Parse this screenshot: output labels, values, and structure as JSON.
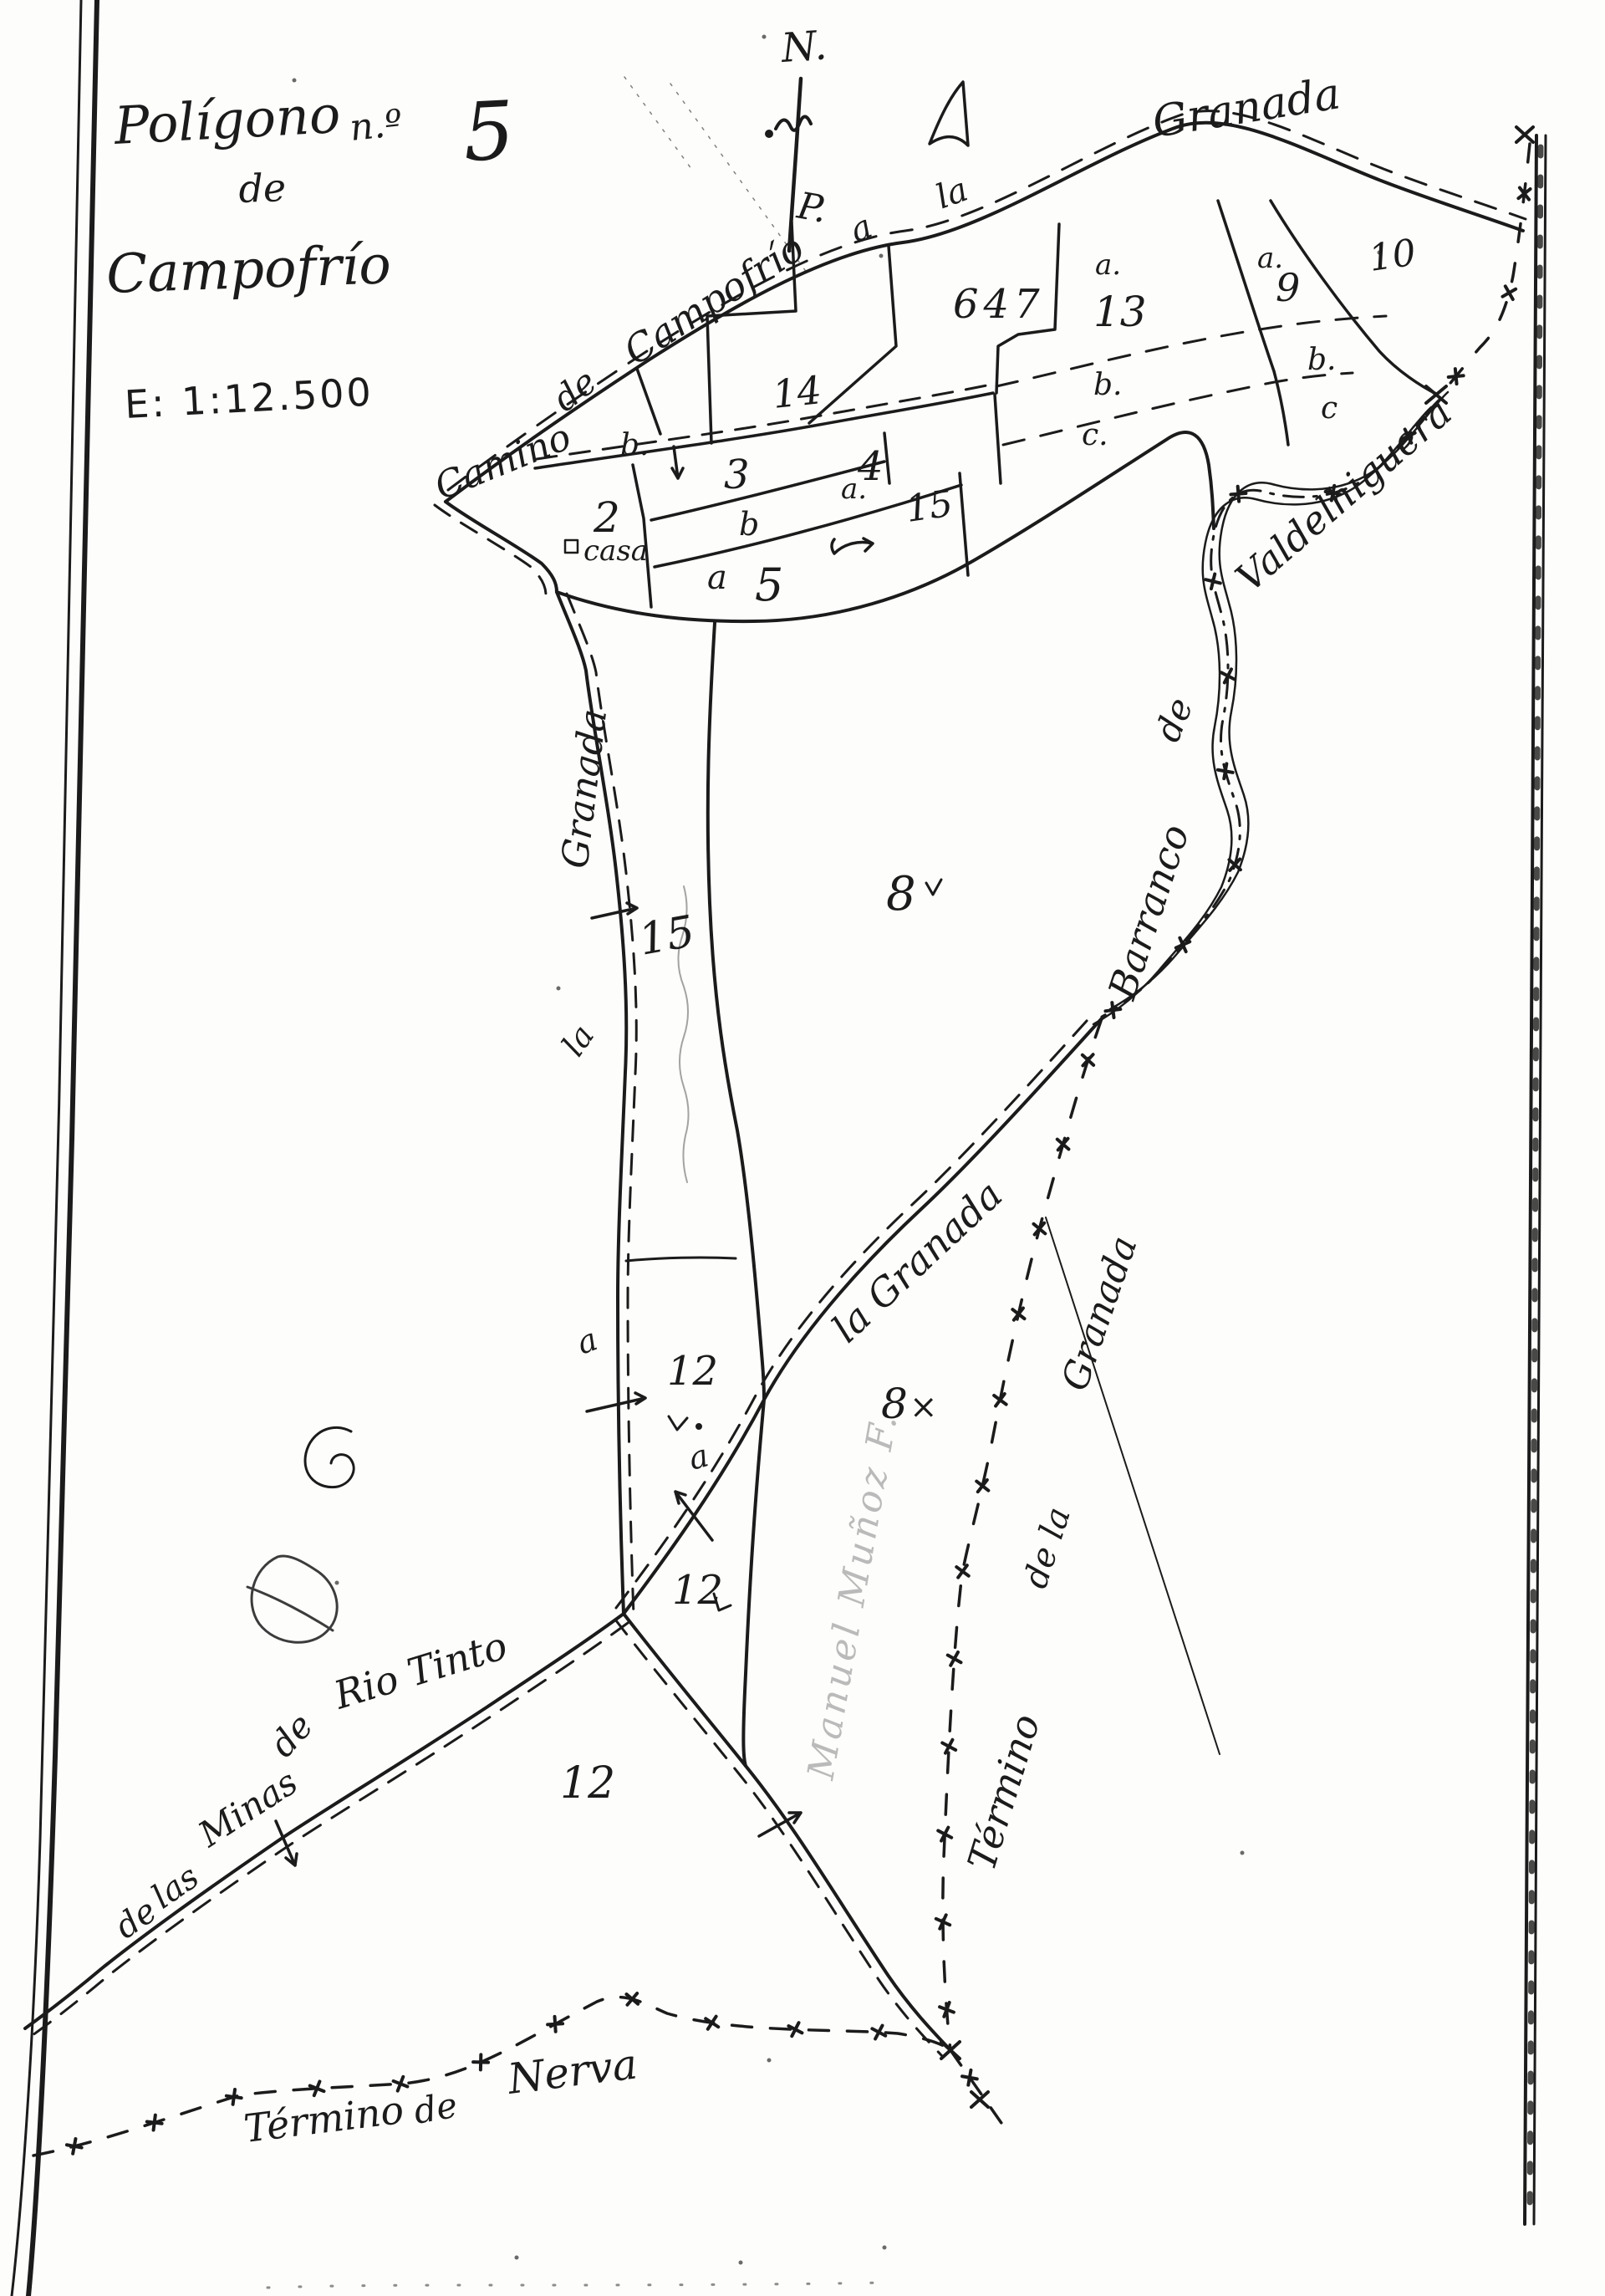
{
  "title": {
    "word1": "Polígono",
    "word2": "n.º",
    "number": "5",
    "word3": "de",
    "word4": "Campofrío",
    "scale": "E: 1:12.500"
  },
  "compass": {
    "north": "N.",
    "p_mark": "P."
  },
  "roads": {
    "camino": "Camino",
    "de": "de",
    "campofrio": "Campofrío",
    "a": "a",
    "la": "la",
    "granada_top": "Granada",
    "la_west": "la",
    "granada_west": "Granada",
    "la_granada_branch": "la Granada",
    "minas_de": "de",
    "minas_las": "las",
    "minas_minas": "Minas",
    "minas_de2": "de",
    "minas_rio_tinto": "Rio Tinto"
  },
  "stream": {
    "barranco": "Barranco",
    "de": "de",
    "name": "Valdelhiguera"
  },
  "boundaries": {
    "granada_termino": "Término",
    "granada_de_la": "de la",
    "granada_name": "Granada",
    "nerva_termino": "Término",
    "nerva_de": "de",
    "nerva_name": "Nerva"
  },
  "parcels": {
    "p2": "2",
    "p3": "3",
    "p4": "4",
    "p5": "5",
    "p8": "8",
    "p8b": "8",
    "p9": "9",
    "p10": "10",
    "p12a": "12",
    "p12b": "12",
    "p12c": "12",
    "p13": "13",
    "p14": "14",
    "p15a": "15",
    "p15b": "15",
    "p647": "647"
  },
  "letters": {
    "b_wedge": "b.",
    "b_strip": "b",
    "a_4": "a.",
    "a_5": "a",
    "b_right": "b.",
    "c_right": "c",
    "a_13": "a.",
    "b_13": "b.",
    "c_13": "c.",
    "a_9": "a.",
    "a_west": "a",
    "a_branch": "a",
    "x_8": "×"
  },
  "buildings": {
    "casa": "casa"
  },
  "owner": {
    "script": "Manuel Muñoz F."
  }
}
